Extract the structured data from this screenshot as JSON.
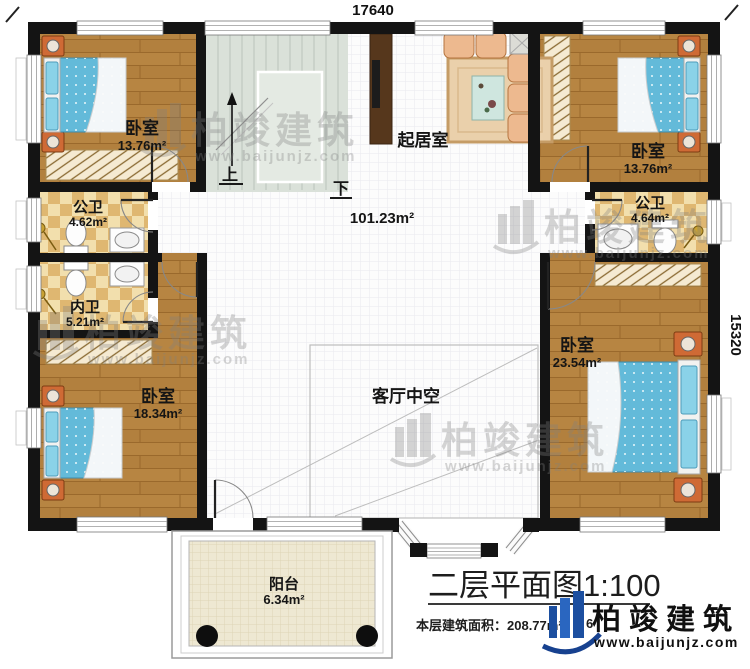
{
  "titleblock": {
    "title": "二层平面图1:100",
    "area_note": "本层建筑面积：208.77m²",
    "fragment": "6"
  },
  "dimensions": {
    "top": "17640",
    "right": "15320"
  },
  "rooms": {
    "bedroom_tl": {
      "name": "卧室",
      "area": "13.76m²"
    },
    "bedroom_tr": {
      "name": "卧室",
      "area": "13.76m²"
    },
    "bedroom_bl": {
      "name": "卧室",
      "area": "18.34m²"
    },
    "bedroom_br": {
      "name": "卧室",
      "area": "23.54m²"
    },
    "bath_public_left": {
      "name": "公卫",
      "area": "4.62m²"
    },
    "bath_private_left": {
      "name": "内卫",
      "area": "5.21m²"
    },
    "bath_public_right": {
      "name": "公卫",
      "area": "4.64m²"
    },
    "living": {
      "name": "起居室"
    },
    "hall": {
      "area": "101.23m²"
    },
    "void": {
      "name": "客厅中空"
    },
    "balcony": {
      "name": "阳台",
      "area": "6.34m²"
    }
  },
  "stairs": {
    "up": "上",
    "down": "下"
  },
  "watermark": {
    "brand": "柏竣建筑",
    "url": "www.baijunjz.com"
  },
  "brand": {
    "name": "柏竣建筑",
    "url": "www.baijunjz.com"
  },
  "colors": {
    "wall": "#141414",
    "wood_floor": "#b2803e",
    "bath_checker": "#dfb771",
    "bed_blue": "#63bad9",
    "stair": "#dae1d9",
    "balcony": "#eee8d2",
    "brand_blue": "#1c4fa0",
    "watermark_gray": "#808080"
  }
}
